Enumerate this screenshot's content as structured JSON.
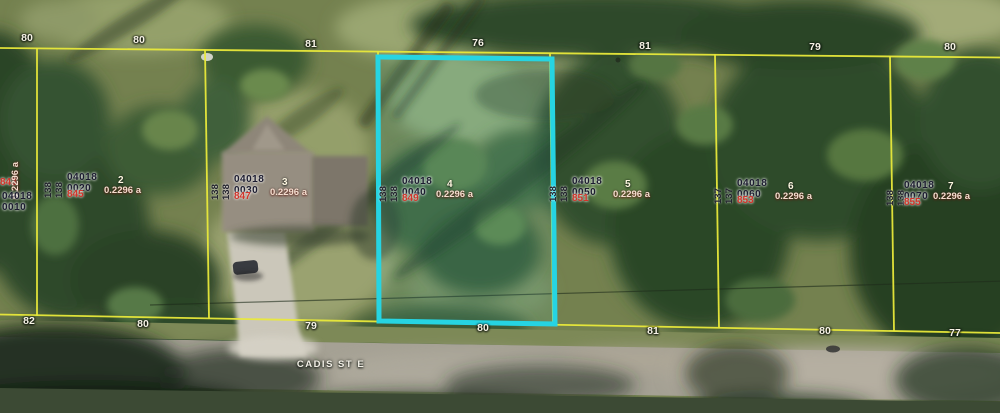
{
  "map": {
    "street_label": "CADIS ST E",
    "colors": {
      "parcel_line": "#e9e93a",
      "highlight": "#26d4e2",
      "address_text": "#d2352b",
      "parcel_id_text": "#1c1c30",
      "dimension_text": "#f7f3e6",
      "area_text": "#f4ddcf"
    },
    "top_dimensions": [
      "80",
      "80",
      "81",
      "76",
      "81",
      "79",
      "80"
    ],
    "bottom_dimensions": [
      "82",
      "80",
      "79",
      "80",
      "81",
      "80",
      "77"
    ],
    "parcels": [
      {
        "block": "04018",
        "lot_code": "0010",
        "address": "843",
        "lot_number": "",
        "area": "0.2296 a",
        "side_dimension": "",
        "highlighted": false
      },
      {
        "block": "04018",
        "lot_code": "0020",
        "address": "845",
        "lot_number": "2",
        "area": "0.2296 a",
        "side_dimension": "138",
        "highlighted": false
      },
      {
        "block": "04018",
        "lot_code": "0030",
        "address": "847",
        "lot_number": "3",
        "area": "0.2296 a",
        "side_dimension": "138",
        "highlighted": false
      },
      {
        "block": "04018",
        "lot_code": "0040",
        "address": "849",
        "lot_number": "4",
        "area": "0.2296 a",
        "side_dimension": "138",
        "highlighted": true
      },
      {
        "block": "04018",
        "lot_code": "0050",
        "address": "851",
        "lot_number": "5",
        "area": "0.2296 a",
        "side_dimension": "138",
        "highlighted": false
      },
      {
        "block": "04018",
        "lot_code": "0060",
        "address": "853",
        "lot_number": "6",
        "area": "0.2296 a",
        "side_dimension": "137",
        "highlighted": false
      },
      {
        "block": "04018",
        "lot_code": "0070",
        "address": "855",
        "lot_number": "7",
        "area": "0.2296 a",
        "side_dimension": "138",
        "highlighted": false
      }
    ]
  }
}
